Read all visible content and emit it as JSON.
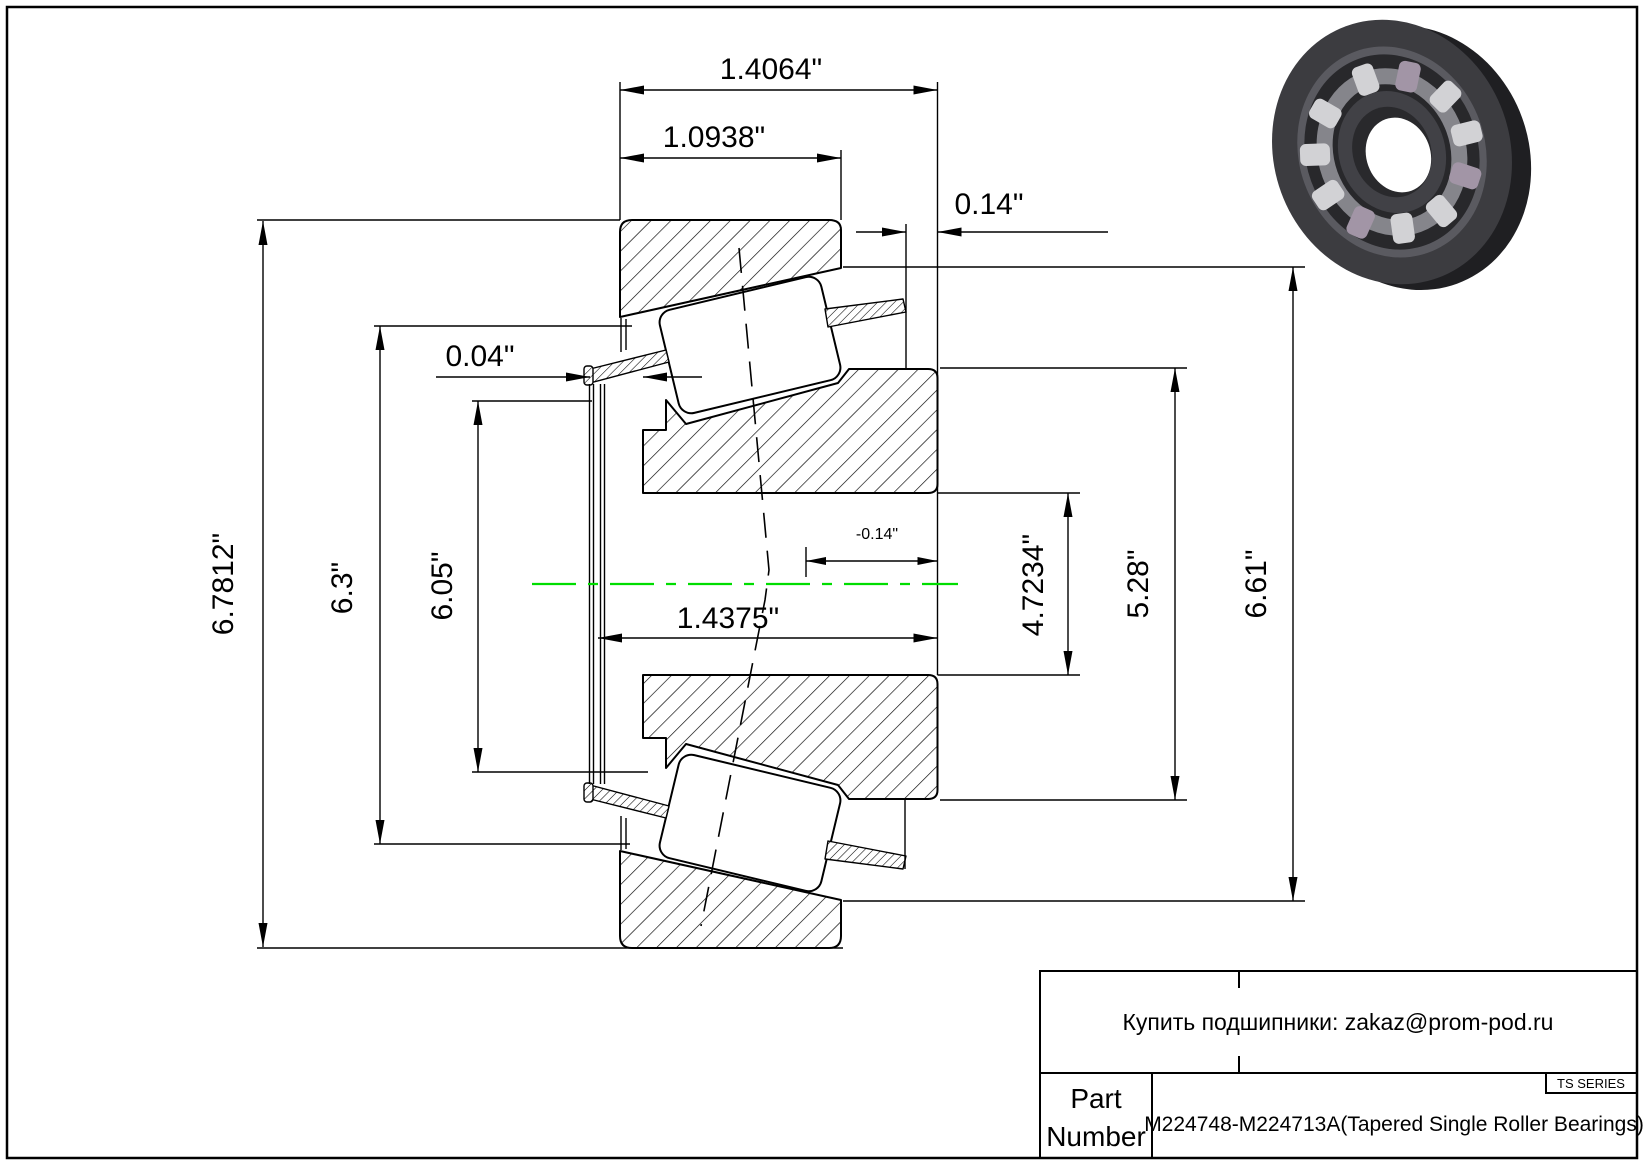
{
  "drawing": {
    "title": "Tapered single roller bearing cross-section drawing",
    "series": "TS SERIES",
    "part_number": "M224748-M224713A(Tapered Single Roller Bearings)"
  },
  "colors": {
    "centerline": "#00dd00",
    "line": "#000000",
    "background": "#ffffff"
  },
  "dims": {
    "flange_width": {
      "label": "1.4064\"",
      "value": 1.4064
    },
    "cup_width": {
      "label": "1.0938\"",
      "value": 1.0938
    },
    "standout": {
      "label": "0.14\"",
      "value": 0.14
    },
    "lip_gap": {
      "label": "0.04\"",
      "value": 0.04
    },
    "offset": {
      "label": "-0.14\"",
      "value": -0.14
    },
    "cone_width": {
      "label": "1.4375\"",
      "value": 1.4375
    },
    "flange_od": {
      "label": "6.7812\"",
      "value": 6.7812
    },
    "back_od": {
      "label": "6.3\"",
      "value": 6.3
    },
    "cage_od": {
      "label": "6.05\"",
      "value": 6.05
    },
    "bore_ref": {
      "label": "4.7234\"",
      "value": 4.7234
    },
    "rib_od": {
      "label": "5.28\"",
      "value": 5.28
    },
    "cup_od": {
      "label": "6.61\"",
      "value": 6.61
    }
  },
  "title_block": {
    "contact": "Купить подшипники: zakaz@prom-pod.ru",
    "part_label_line1": "Part",
    "part_label_line2": "Number",
    "series": "TS SERIES",
    "description": "M224748-M224713A(Tapered Single Roller Bearings)"
  }
}
